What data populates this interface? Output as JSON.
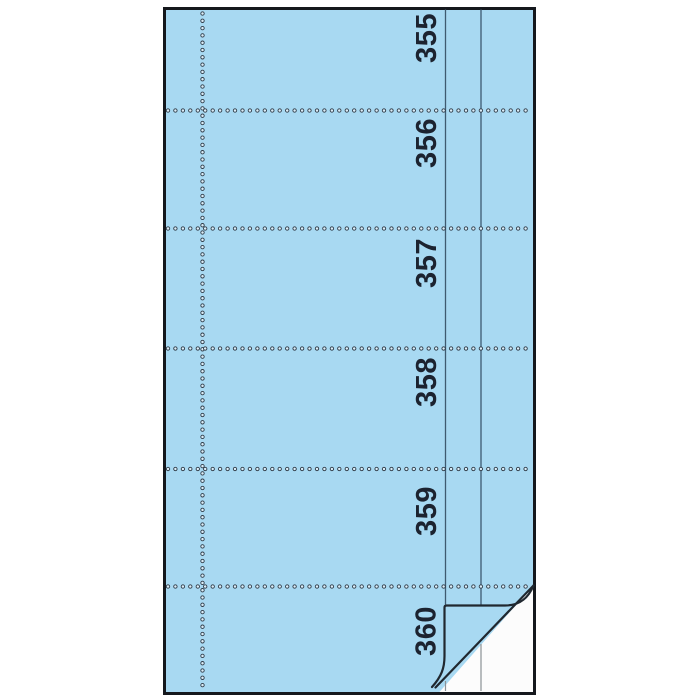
{
  "pad": {
    "coupon_numbers": [
      "355",
      "356",
      "357",
      "358",
      "359",
      "360"
    ]
  },
  "colors": {
    "background": "#ffffff",
    "paper_blue": "#a8d9f2",
    "outline": "#15181d",
    "ruled_line": "#3e5a70",
    "underlay_paper": "#fcfcfc",
    "underlay_line": "#8b9196",
    "number_ink": "#1c2330",
    "perf_ring": "#2e3a46",
    "perf_fill": "#ddeffa",
    "crease_ink": "#202830"
  }
}
